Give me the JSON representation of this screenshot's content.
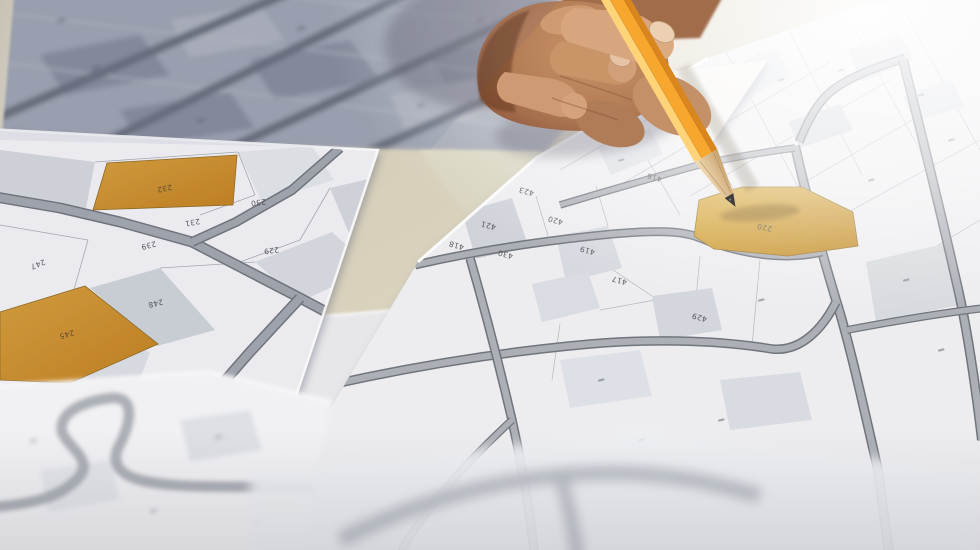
{
  "scene": {
    "left_map": {
      "parcels": [
        "232",
        "245",
        "247",
        "239",
        "231",
        "230",
        "229",
        "228",
        "233",
        "248"
      ],
      "highlighted_parcels": [
        "232",
        "245"
      ]
    },
    "right_map": {
      "parcels": [
        "220",
        "423",
        "421",
        "420",
        "419",
        "418",
        "417",
        "416",
        "430",
        "429"
      ],
      "highlighted_parcels": [
        "220"
      ],
      "target_parcel": "220"
    },
    "corner_map": {
      "parcels": [
        "234"
      ]
    },
    "colors": {
      "highlight_orange": "#c8892c",
      "target_orange": "#d2a135",
      "pencil_orange": "#f7a72e",
      "road_gray": "#9aa0a8",
      "parcel_gray": "#ced1d8",
      "paper_white": "#ebebee",
      "desk_beige": "#d5cdb6",
      "skin_mid": "#b5805f"
    }
  }
}
